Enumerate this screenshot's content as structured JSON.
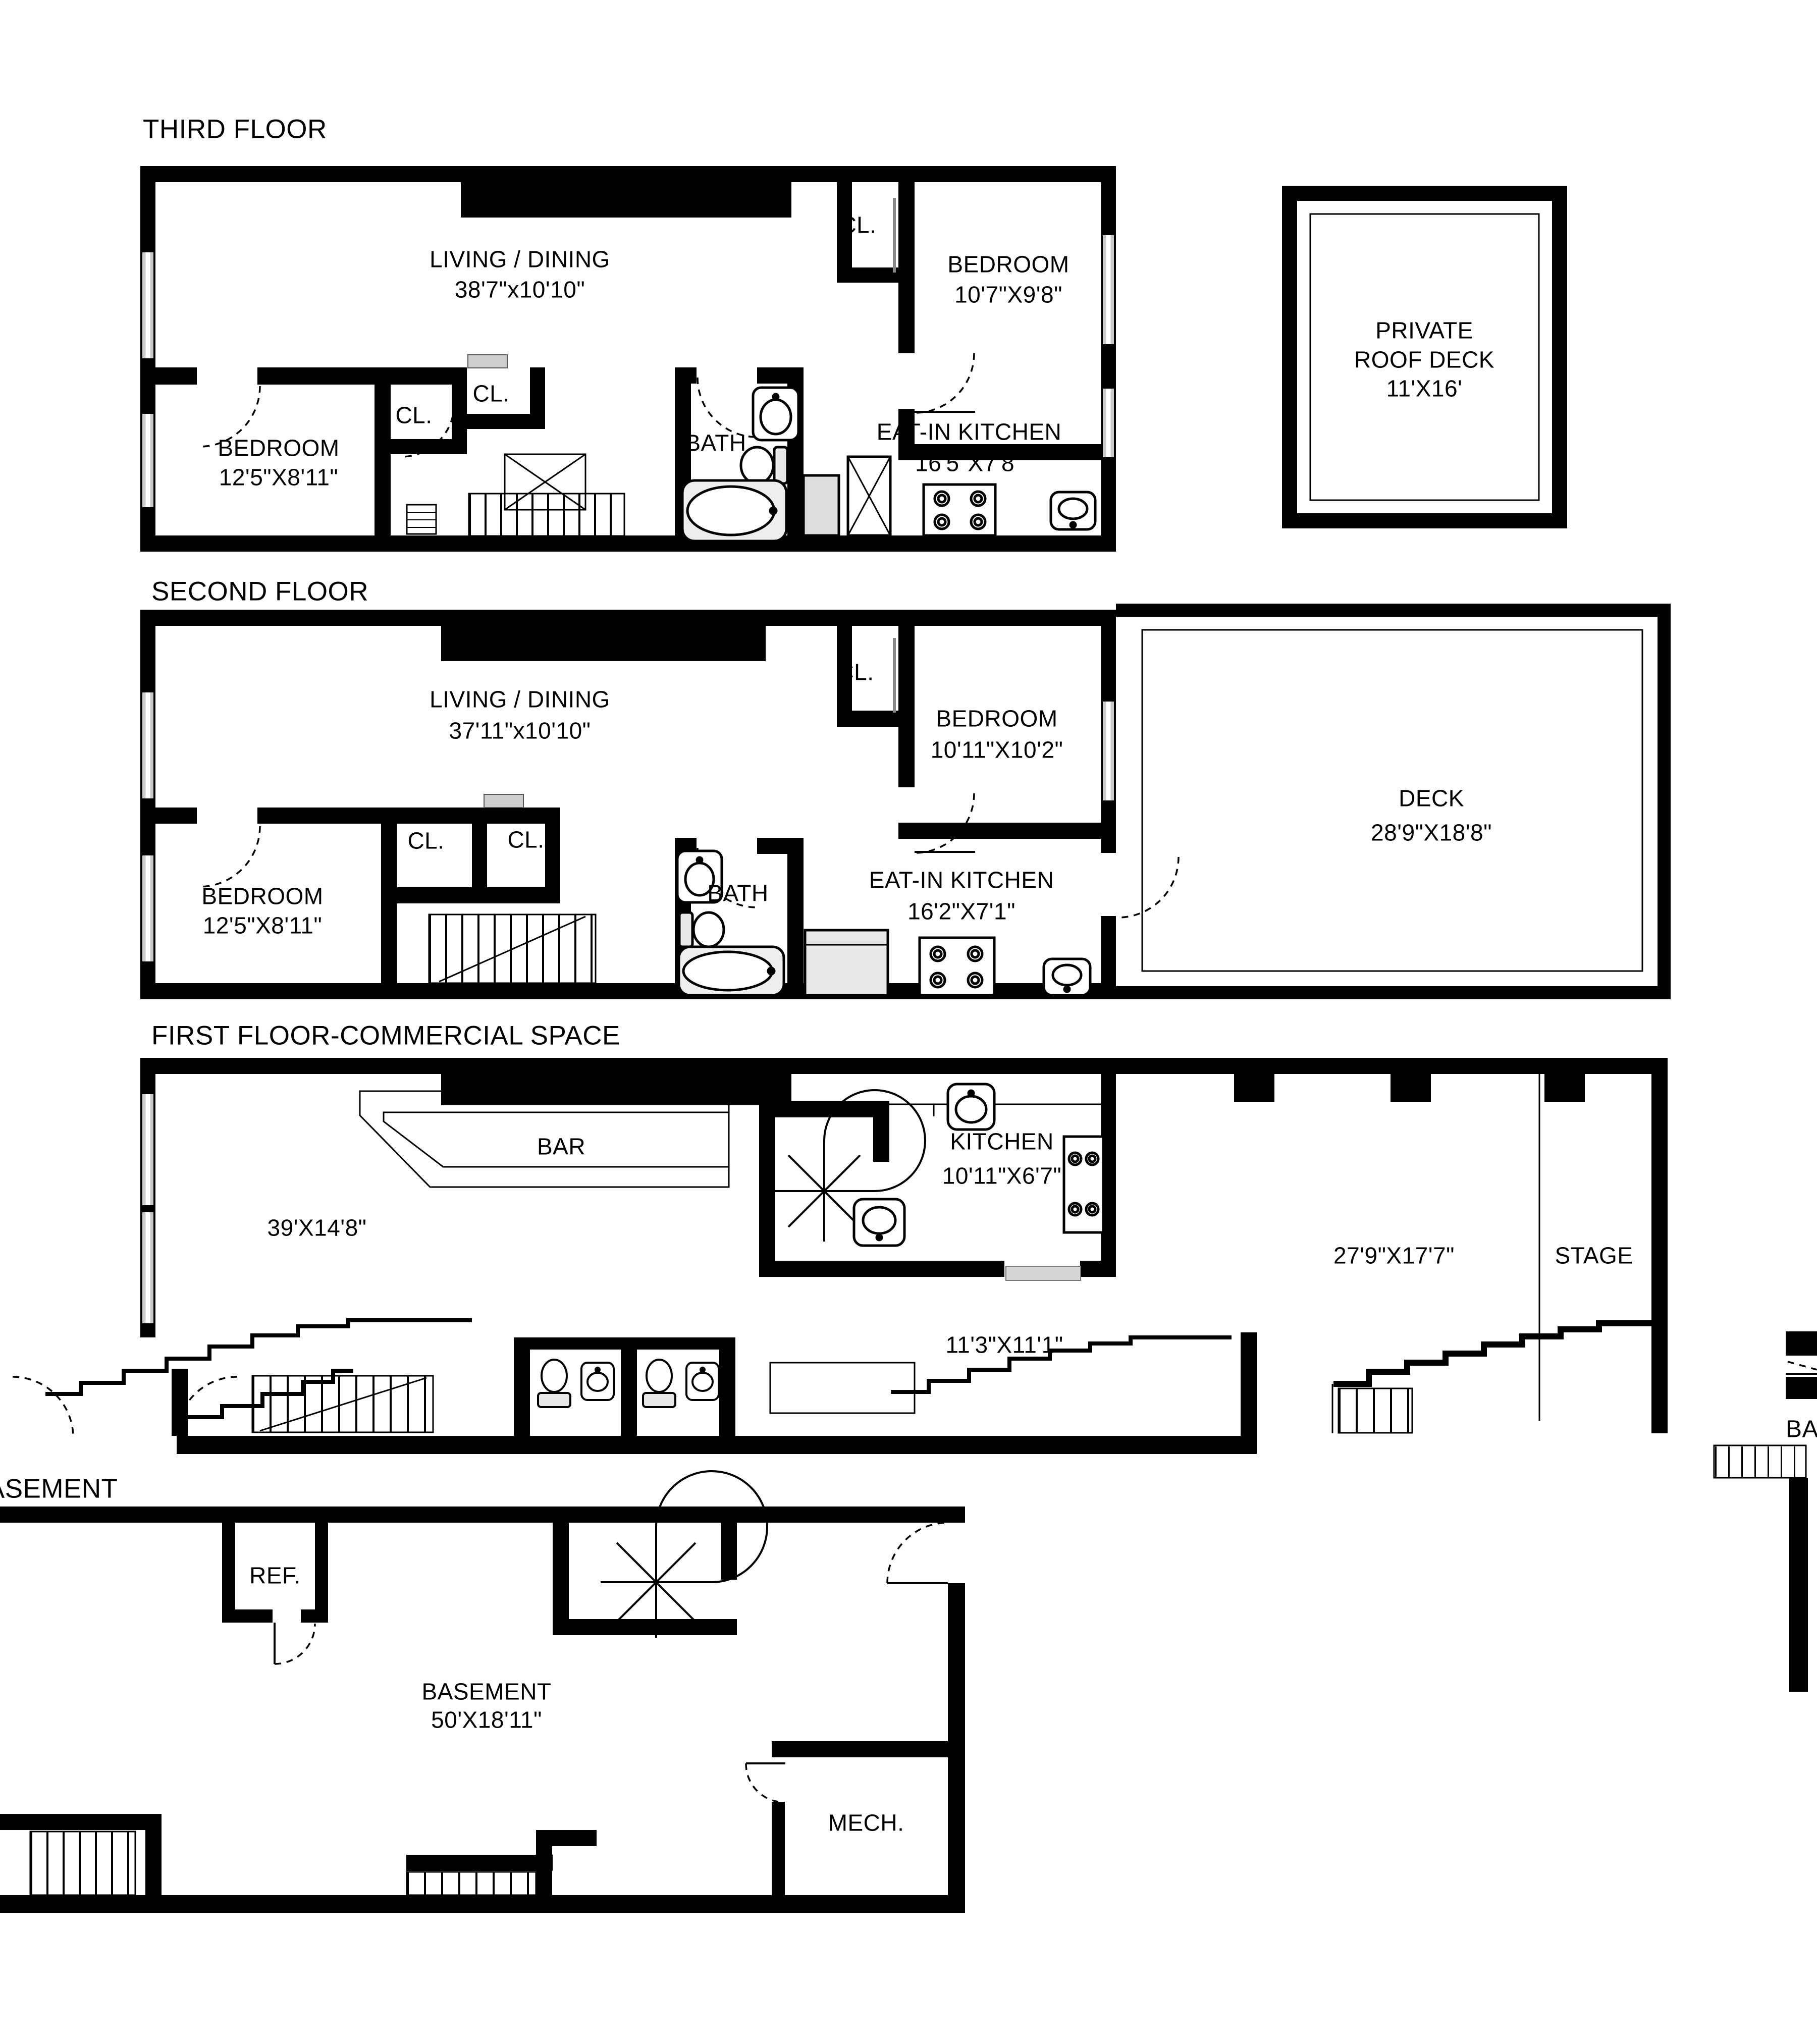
{
  "page": {
    "background": "#ffffff",
    "ink": "#000000"
  },
  "floors": {
    "third": {
      "title": "THIRD FLOOR",
      "living": {
        "name": "LIVING / DINING",
        "dims": "38'7\"x10'10\""
      },
      "bedroom_left": {
        "name": "BEDROOM",
        "dims": "12'5\"X8'11\""
      },
      "bedroom_right": {
        "name": "BEDROOM",
        "dims": "10'7\"X9'8\""
      },
      "eat_in_kitchen": {
        "name": "EAT-IN KITCHEN",
        "dims": "16'5\"X7'8\""
      },
      "bath": {
        "name": "BATH"
      },
      "closet_1": {
        "name": "CL."
      },
      "closet_2": {
        "name": "CL."
      },
      "closet_right": {
        "name": "CL."
      }
    },
    "roof_deck": {
      "name_line1": "PRIVATE",
      "name_line2": "ROOF DECK",
      "dims": "11'X16'"
    },
    "second": {
      "title": "SECOND FLOOR",
      "living": {
        "name": "LIVING / DINING",
        "dims": "37'11\"x10'10\""
      },
      "bedroom_left": {
        "name": "BEDROOM",
        "dims": "12'5\"X8'11\""
      },
      "bedroom_right": {
        "name": "BEDROOM",
        "dims": "10'11\"X10'2\""
      },
      "eat_in_kitchen": {
        "name": "EAT-IN KITCHEN",
        "dims": "16'2\"X7'1\""
      },
      "bath": {
        "name": "BATH"
      },
      "closet_1": {
        "name": "CL."
      },
      "closet_2": {
        "name": "CL."
      },
      "closet_right": {
        "name": "CL."
      },
      "deck": {
        "name": "DECK",
        "dims": "28'9\"X18'8\""
      }
    },
    "first": {
      "title": "FIRST FLOOR-COMMERCIAL SPACE",
      "bar": {
        "name": "BAR"
      },
      "front_room_dims": "39'X14'8\"",
      "kitchen": {
        "name": "KITCHEN",
        "dims": "10'11\"X6'7\""
      },
      "back_room_dims": "27'9\"X17'7\"",
      "stage": {
        "name": "STAGE"
      },
      "lower_room_dims": "11'3\"X11'1\""
    },
    "basement": {
      "title": "BASEMENT",
      "room": {
        "name": "BASEMENT",
        "dims": "50'X18'11\""
      },
      "ref": {
        "name": "REF."
      },
      "mech": {
        "name": "MECH."
      }
    },
    "edge_fragment": {
      "partial_label": "BA"
    }
  }
}
